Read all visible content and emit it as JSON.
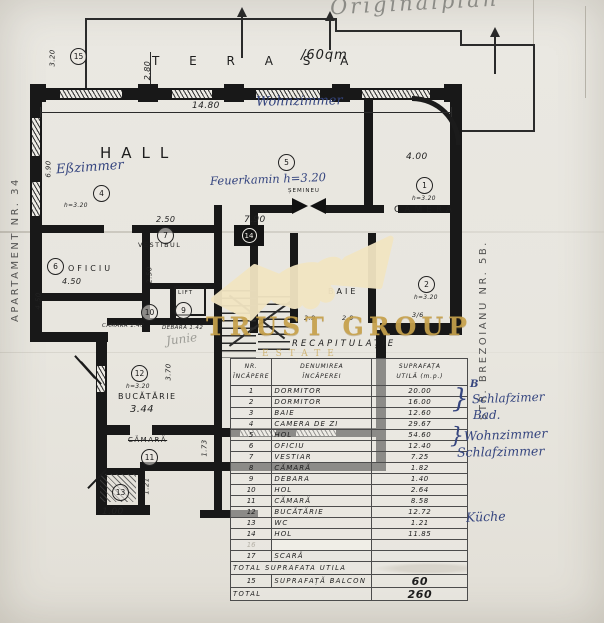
{
  "colors": {
    "gold": "#c6a14b",
    "ink_blue": "#35457f",
    "paper": "#e8e6df",
    "line": "#1b1b1b"
  },
  "watermark": {
    "brand": "TRUST GROUP",
    "sub": "ESTATE"
  },
  "handwriting": {
    "top_pencil": "Originalplan",
    "plan_wohnzimmer": "Wohnzimmer",
    "plan_esszimmer": "Eßzimmer",
    "plan_feuerkamin": "Feuerkamin h=3.20",
    "scribble": "Junie",
    "margin_b": "B",
    "brace": "}",
    "margin_notes": [
      {
        "text": "Schlafzimer"
      },
      {
        "text": "Bad."
      },
      {
        "text": "Wohnzimmer"
      },
      {
        "text": "Schlafzimmer"
      },
      {
        "text": "Küche"
      }
    ],
    "street_left": "APARTAMENT NR. 34",
    "street_right": "STR. BREZOIANU NR. 5B."
  },
  "plan": {
    "labels": {
      "terasa": "T E R A S A",
      "terasa_area": "/60qm",
      "hall": "HALL",
      "oficiu": "OFICIU",
      "vestibul": "VESTIBUL",
      "camera": "CAMERA",
      "baie": "BAIE",
      "semineu": "ȘEMINEU",
      "lift": "LIFT",
      "bucatarie": "BUCĂTĂRIE",
      "camara_struck": "CĂMARĂ"
    },
    "dims": {
      "terrace_height": "2.80",
      "terrace_left": "3.20",
      "overall_width": "14.80",
      "hall_left": "6.90",
      "camera_width": "4.00",
      "vestibul_width": "2.50",
      "hol_width": "7.90",
      "oficiu_width": "4.50",
      "oficiu_height": "2.50",
      "left_lower": "4.50",
      "kitchen_width": "3.44",
      "kitchen_height": "3.70",
      "camara_height": "1.73",
      "wc_height": "1.21",
      "wc_width": "1.00",
      "baie_a": "2.9",
      "baie_b": "2.8",
      "baie_c": "3/6",
      "h320_hall": "h=3.20",
      "h320_camera": "h=3.20",
      "h320_room2": "h=3.20",
      "h320_kitchen": "h=3.20",
      "camara_small": "CĂMARĂ 1.40",
      "debara_small": "DEBARA 1.42"
    },
    "circles": {
      "c1": "1",
      "c2": "2",
      "c4": "4",
      "c5": "5",
      "c6": "6",
      "c7": "7",
      "c9": "9",
      "c10": "10",
      "c11": "11",
      "c12": "12",
      "c13": "13",
      "c14": "14",
      "c15": "15"
    }
  },
  "table": {
    "title": "RECAPITULAȚIE",
    "headers": {
      "col1a": "NR.",
      "col1b": "ÎNCĂPERE",
      "col2a": "DENUMIREA",
      "col2b": "ÎNCĂPEREI",
      "col3a": "SUPRAFAȚA",
      "col3b": "UTILĂ (m.p.)"
    },
    "rows": [
      {
        "nr": "1",
        "name": "DORMITOR",
        "area": "20.00"
      },
      {
        "nr": "2",
        "name": "DORMITOR",
        "area": "16.00"
      },
      {
        "nr": "3",
        "name": "BAIE",
        "area": "12.60"
      },
      {
        "nr": "4",
        "name": "CAMERA DE ZI",
        "area": "29.67"
      },
      {
        "nr": "5",
        "name": "HOL",
        "area": "54.60"
      },
      {
        "nr": "6",
        "name": "OFICIU",
        "area": "12.40"
      },
      {
        "nr": "7",
        "name": "VESTIAR",
        "area": "7.25"
      },
      {
        "nr": "8",
        "name": "CĂMARĂ",
        "area": "1.82"
      },
      {
        "nr": "9",
        "name": "DEBARA",
        "area": "1.40"
      },
      {
        "nr": "10",
        "name": "HOL",
        "area": "2.64"
      },
      {
        "nr": "11",
        "name": "CĂMARĂ",
        "area": "8.58"
      },
      {
        "nr": "12",
        "name": "BUCĂTĂRIE",
        "area": "12.72"
      },
      {
        "nr": "13",
        "name": "WC",
        "area": "1.21"
      },
      {
        "nr": "14",
        "name": "HOL",
        "area": "11.85"
      },
      {
        "nr": "16",
        "name": "",
        "area": "",
        "faint": true
      },
      {
        "nr": "17",
        "name": "SCARĂ",
        "area": ""
      }
    ],
    "footer": [
      {
        "nr": "",
        "label": "TOTAL SUPRAFATA UTILA",
        "value": "",
        "span2": true,
        "smudge": true
      },
      {
        "nr": "15",
        "label": "SUPRAFAȚĂ BALCON",
        "value": "60",
        "big": true
      },
      {
        "nr": "",
        "label": "TOTAL",
        "value": "260",
        "span2": true,
        "big": true
      }
    ]
  }
}
